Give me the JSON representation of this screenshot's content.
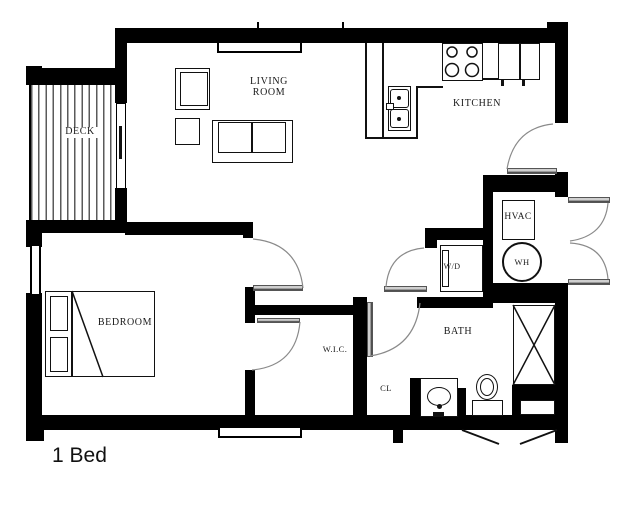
{
  "plan": {
    "title": "1 Bed"
  },
  "rooms": {
    "deck": {
      "label": "DECK"
    },
    "living": {
      "label": "LIVING ROOM"
    },
    "kitchen": {
      "label": "KITCHEN"
    },
    "bedroom": {
      "label": "BEDROOM"
    },
    "wic": {
      "label": "W.I.C."
    },
    "closet": {
      "label": "CL"
    },
    "bath": {
      "label": "BATH"
    }
  },
  "equipment": {
    "hvac": {
      "label": "HVAC"
    },
    "water_heater": {
      "label": "WH"
    },
    "washer_dryer": {
      "label": "W/D"
    }
  },
  "colors": {
    "walls": "#000000",
    "background": "#ffffff",
    "door_arc": "#8a8a8a",
    "deck_board": "#5a5a5a"
  }
}
